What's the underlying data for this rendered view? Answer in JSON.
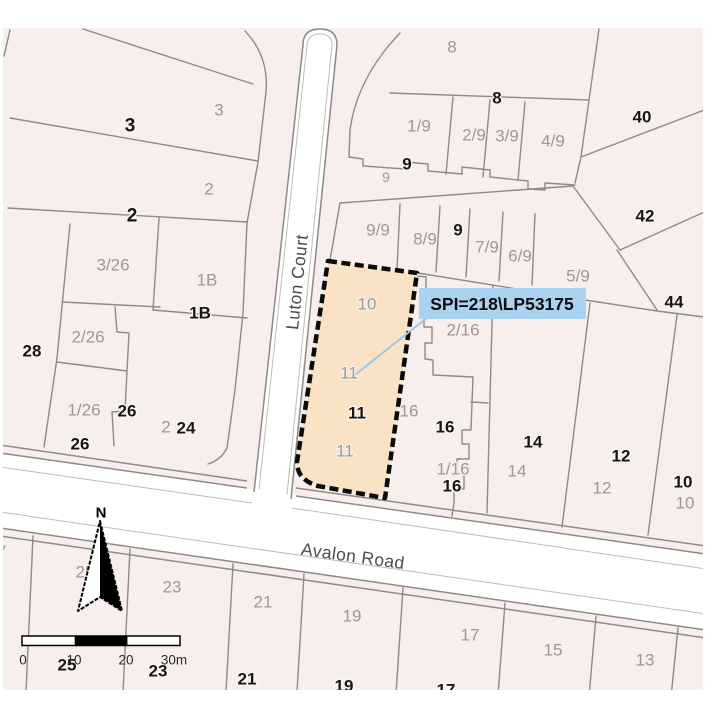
{
  "map": {
    "background_color": "#f8efec",
    "parcel_line_color": "#8d8a88",
    "highlight": {
      "fill": "#f9e3c4",
      "border": "#0a0a0a"
    },
    "callout": {
      "text": "SPI=218\\LP53175",
      "bg": "#a9d3ee",
      "leader_color": "#9cc7e6"
    },
    "roads": [
      {
        "name": "Luton Court"
      },
      {
        "name": "Avalon Road"
      }
    ],
    "north_label": "N",
    "scale": {
      "ticks": [
        "0",
        "10",
        "20",
        "30m"
      ]
    },
    "lot_labels_gray": [
      {
        "t": "3",
        "x": 219,
        "y": 110
      },
      {
        "t": "2",
        "x": 209,
        "y": 189
      },
      {
        "t": "3/26",
        "x": 113,
        "y": 265
      },
      {
        "t": "1B",
        "x": 207,
        "y": 280
      },
      {
        "t": "2/26",
        "x": 88,
        "y": 337
      },
      {
        "t": "1/26",
        "x": 84,
        "y": 410
      },
      {
        "t": "2",
        "x": 166,
        "y": 427
      },
      {
        "t": "8",
        "x": 452,
        "y": 47
      },
      {
        "t": "1/9",
        "x": 419,
        "y": 126
      },
      {
        "t": "2/9",
        "x": 474,
        "y": 135
      },
      {
        "t": "3/9",
        "x": 507,
        "y": 136
      },
      {
        "t": "4/9",
        "x": 553,
        "y": 141
      },
      {
        "t": "9",
        "x": 386,
        "y": 177,
        "size": 14
      },
      {
        "t": "9/9",
        "x": 378,
        "y": 230
      },
      {
        "t": "8/9",
        "x": 425,
        "y": 239
      },
      {
        "t": "7/9",
        "x": 487,
        "y": 247
      },
      {
        "t": "6/9",
        "x": 520,
        "y": 256
      },
      {
        "t": "5/9",
        "x": 578,
        "y": 276
      },
      {
        "t": "2/16",
        "x": 463,
        "y": 330
      },
      {
        "t": "10",
        "x": 367,
        "y": 304
      },
      {
        "t": "11",
        "x": 349,
        "y": 373
      },
      {
        "t": "11",
        "x": 345,
        "y": 451
      },
      {
        "t": "16",
        "x": 409,
        "y": 411
      },
      {
        "t": "1/16",
        "x": 453,
        "y": 469
      },
      {
        "t": "14",
        "x": 517,
        "y": 471
      },
      {
        "t": "12",
        "x": 602,
        "y": 488
      },
      {
        "t": "10",
        "x": 685,
        "y": 503
      },
      {
        "t": "25",
        "x": 85,
        "y": 572
      },
      {
        "t": "23",
        "x": 172,
        "y": 587
      },
      {
        "t": "21",
        "x": 263,
        "y": 602
      },
      {
        "t": "19",
        "x": 352,
        "y": 616
      },
      {
        "t": "17",
        "x": 470,
        "y": 635
      },
      {
        "t": "15",
        "x": 553,
        "y": 650
      },
      {
        "t": "13",
        "x": 645,
        "y": 660
      },
      {
        "t": "7",
        "x": 2,
        "y": 551,
        "size": 15
      }
    ],
    "street_numbers_bold": [
      {
        "t": "3",
        "x": 130,
        "y": 126,
        "size": 19
      },
      {
        "t": "2",
        "x": 132,
        "y": 216,
        "size": 19
      },
      {
        "t": "1B",
        "x": 200,
        "y": 313
      },
      {
        "t": "28",
        "x": 32,
        "y": 351
      },
      {
        "t": "26",
        "x": 127,
        "y": 411
      },
      {
        "t": "26",
        "x": 80,
        "y": 444
      },
      {
        "t": "24",
        "x": 186,
        "y": 428
      },
      {
        "t": "8",
        "x": 497,
        "y": 98
      },
      {
        "t": "9",
        "x": 407,
        "y": 164
      },
      {
        "t": "9",
        "x": 458,
        "y": 230
      },
      {
        "t": "40",
        "x": 642,
        "y": 117
      },
      {
        "t": "42",
        "x": 645,
        "y": 216
      },
      {
        "t": "44",
        "x": 674,
        "y": 302
      },
      {
        "t": "11",
        "x": 357,
        "y": 413
      },
      {
        "t": "16",
        "x": 445,
        "y": 427
      },
      {
        "t": "16",
        "x": 452,
        "y": 486
      },
      {
        "t": "14",
        "x": 533,
        "y": 442
      },
      {
        "t": "12",
        "x": 621,
        "y": 456
      },
      {
        "t": "10",
        "x": 683,
        "y": 482
      },
      {
        "t": "25",
        "x": 67,
        "y": 665
      },
      {
        "t": "23",
        "x": 158,
        "y": 671
      },
      {
        "t": "21",
        "x": 247,
        "y": 679
      },
      {
        "t": "19",
        "x": 344,
        "y": 686
      },
      {
        "t": "17",
        "x": 446,
        "y": 690
      }
    ]
  }
}
